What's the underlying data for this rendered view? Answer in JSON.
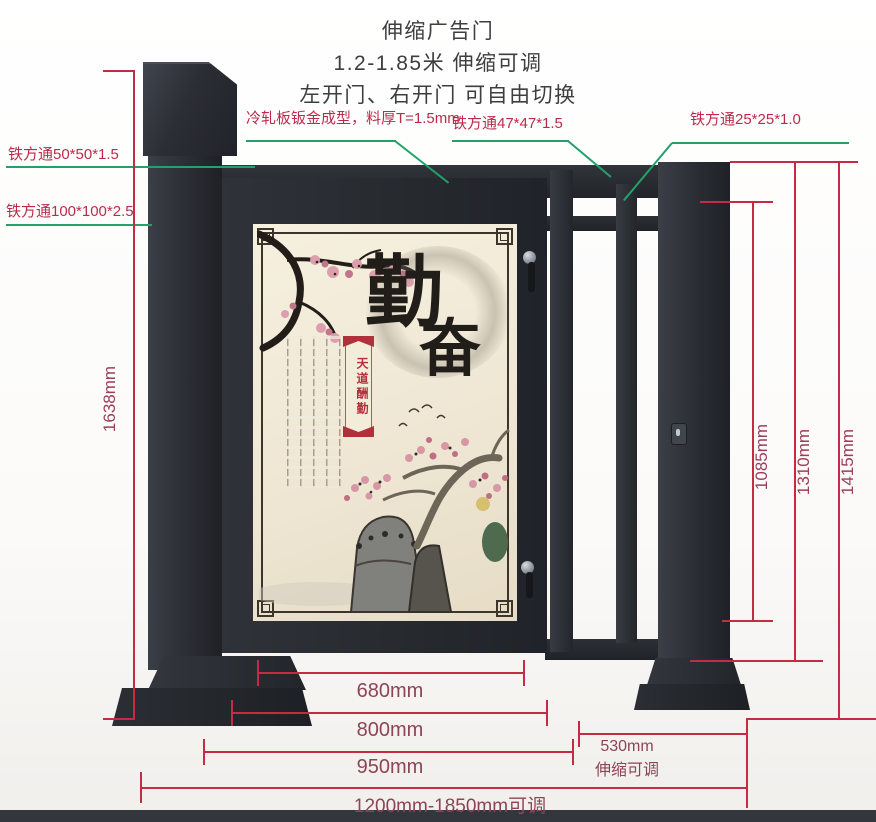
{
  "title": {
    "line1": "伸缩广告门",
    "line2": "1.2-1.85米 伸缩可调",
    "line3": "左开门、右开门 可自由切换"
  },
  "callouts": {
    "cold_rolled": "冷轧板钣金成型，料厚T=1.5mm",
    "tube_47": "铁方通47*47*1.5",
    "tube_25": "铁方通25*25*1.0",
    "tube_50": "铁方通50*50*1.5",
    "tube_100": "铁方通100*100*2.5"
  },
  "dimensions": {
    "post_height": "1638mm",
    "inner_height": "1085mm",
    "frame_height": "1310mm",
    "total_height": "1415mm",
    "poster_width": "680mm",
    "door_width": "800mm",
    "door_section_width": "950mm",
    "extend_value": "530mm",
    "extend_note": "伸缩可调",
    "total_width": "1200mm-1850mm可调"
  },
  "poster": {
    "calligraphy_1": "勤",
    "calligraphy_2": "奋",
    "banner": "天道酬勤"
  },
  "colors": {
    "dimension_line": "#c62a45",
    "dimension_text": "#9c3e58",
    "callout_line": "#23a06b",
    "callout_text": "#bb2c4c",
    "gate_steel": "#2a2d33",
    "poster_cream": "#efe7d4",
    "banner_red": "#b2303b"
  }
}
